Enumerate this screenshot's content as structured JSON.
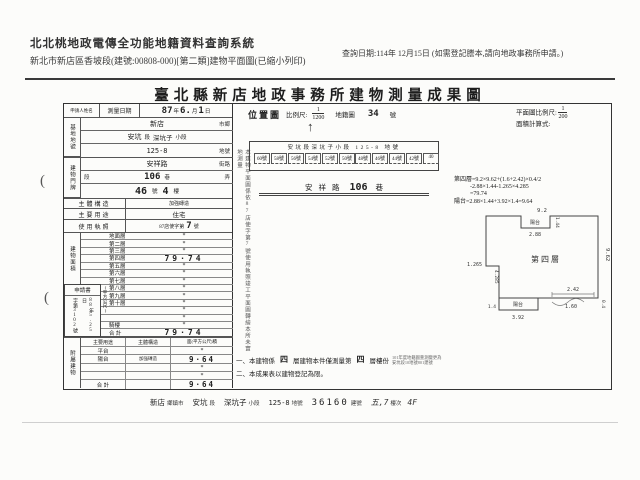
{
  "page": {
    "sys_title": "北北桃地政電傳全功能地籍資料查詢系統",
    "sub_title": "新北市新店區香坡段(建號:00808-000)[第二類]建物平面圖(已縮小列印)",
    "query_date": "查詢日期:114年 12月15日 (如需登記謄本,請向地政事務所申請。)",
    "doc_title": "臺北縣新店地政事務所建物測量成果圖"
  },
  "left_table": {
    "applicant_label": "申請人姓名",
    "survey_label": "測量日期",
    "date": {
      "y": "87",
      "y_unit": "年",
      "m": "6.",
      "m_unit": "月",
      "d": "1",
      "d_unit": "日"
    },
    "site": {
      "glabel": "基地地號",
      "city": "新店",
      "city_lab": "市鄉",
      "sect": "安坑",
      "sect_unit": "段",
      "subsect": "深坑子",
      "subsect_unit": "小段",
      "parcel": "125-8",
      "parcel_lab": "地號"
    },
    "addr": {
      "glabel": "建物門牌",
      "street": "安祥路",
      "street_lab": "街路",
      "seg_lab": "段",
      "lane": "106",
      "lane_lab": "巷",
      "alley_lab": "弄",
      "no": "46",
      "no_lab": "號",
      "fl": "4",
      "fl_lab": "樓"
    },
    "structure_label": "主體構造",
    "structure": "加強磚造",
    "use_label": "主要用途",
    "use": "住宅",
    "lic_label": "使用執照",
    "lic_prefix": "87店使字第",
    "lic_no": "7",
    "lic_suffix": "號",
    "area_label": "建物面積",
    "area_unit": "(平方公尺)",
    "floors": [
      {
        "label": "地面層",
        "value": "*"
      },
      {
        "label": "第二層",
        "value": "*"
      },
      {
        "label": "第三層",
        "value": "*"
      },
      {
        "label": "第四層",
        "value": "79·74"
      },
      {
        "label": "第五層",
        "value": "*"
      },
      {
        "label": "第六層",
        "value": "*"
      },
      {
        "label": "第七層",
        "value": "*"
      },
      {
        "label": "第八層",
        "value": "*"
      },
      {
        "label": "第九層",
        "value": "*"
      },
      {
        "label": "第十層",
        "value": "*"
      },
      {
        "label": "",
        "value": "*"
      },
      {
        "label": "",
        "value": "*"
      },
      {
        "label": "騎樓",
        "value": "*"
      },
      {
        "label": "合 計",
        "value": "79·74"
      }
    ],
    "application": {
      "label": "申請書",
      "date": "88年5.25日",
      "no": "字第3102號"
    }
  },
  "attached": {
    "glabel": "附屬建物",
    "h1": "主要用途",
    "h2": "主體構造",
    "h3": "面(平方公尺)積",
    "rows": [
      {
        "use": "平台",
        "struct": "",
        "area": "*"
      },
      {
        "use": "陽台",
        "struct": "加強磚造",
        "area": "9·64"
      },
      {
        "use": "",
        "struct": "",
        "area": "*"
      },
      {
        "use": "",
        "struct": "",
        "area": "*"
      },
      {
        "use": "合 計",
        "struct": "",
        "area": "9·64"
      }
    ]
  },
  "map": {
    "title": "位置圖",
    "scale_label": "比例尺:",
    "num": "1",
    "den": "1200",
    "sheet_label": "地籍圖",
    "sheet": "34",
    "sheet_unit": "號",
    "north": "↑",
    "header": "安坑段深坑子小段 125-8 地號",
    "houses_l": [
      "60號",
      "58號",
      "56號",
      "54號",
      "52號",
      "50號"
    ],
    "houses_r": [
      "48號",
      "46號",
      "44號",
      "42號",
      "40"
    ],
    "road": "安祥路",
    "road_no": "106",
    "road_unit": "巷"
  },
  "plan": {
    "scale_label": "平面圖比例尺:",
    "num": "1",
    "den": "200",
    "formula_label": "面積計算式:",
    "calc1": "第四層=9.2×9.62+(1.6+2.42)×0.4/2",
    "calc2": "-2.88×1.44-1.265×4.285",
    "calc3": "=79.74",
    "calc4": "陽台=2.88×1.44+3.92×1.4=9.64",
    "floor": "第四層",
    "balcony": "陽台",
    "dims": {
      "top": "9.2",
      "right": "9.62",
      "notch_w": "2.88",
      "notch_d": "1.44",
      "left": "1.265",
      "left2": "4.285",
      "bw": "3.92",
      "bh": "1.4",
      "b1": "2.42",
      "b2": "1.60",
      "b3": "0.4"
    }
  },
  "vnote": "本建物平面圖係依87店使字第7號使用執照竣工平面圖轉繪本所未實地測量",
  "notes": {
    "n1a": "一、本建物係",
    "n1f1": "四",
    "n1b": "層建物本件僅測量第",
    "n1f2": "四",
    "n1c": "層樓份",
    "stamp1": "101年度地籍圖重測變更為",
    "stamp2": "安坑段10地號801建號",
    "n2": "二、本成果表以建物登記為限。"
  },
  "footer": {
    "items": [
      {
        "v": "新店",
        "l": "鄉鎮市"
      },
      {
        "v": "安坑",
        "l": "段"
      },
      {
        "v": "深坑子",
        "l": "小段"
      },
      {
        "v": "125-8",
        "l": "地號"
      },
      {
        "v": "36160",
        "l": "建號"
      },
      {
        "v": "五,7",
        "l": "樓次"
      }
    ],
    "floor": "4F"
  },
  "marks": {
    "paren": "("
  }
}
